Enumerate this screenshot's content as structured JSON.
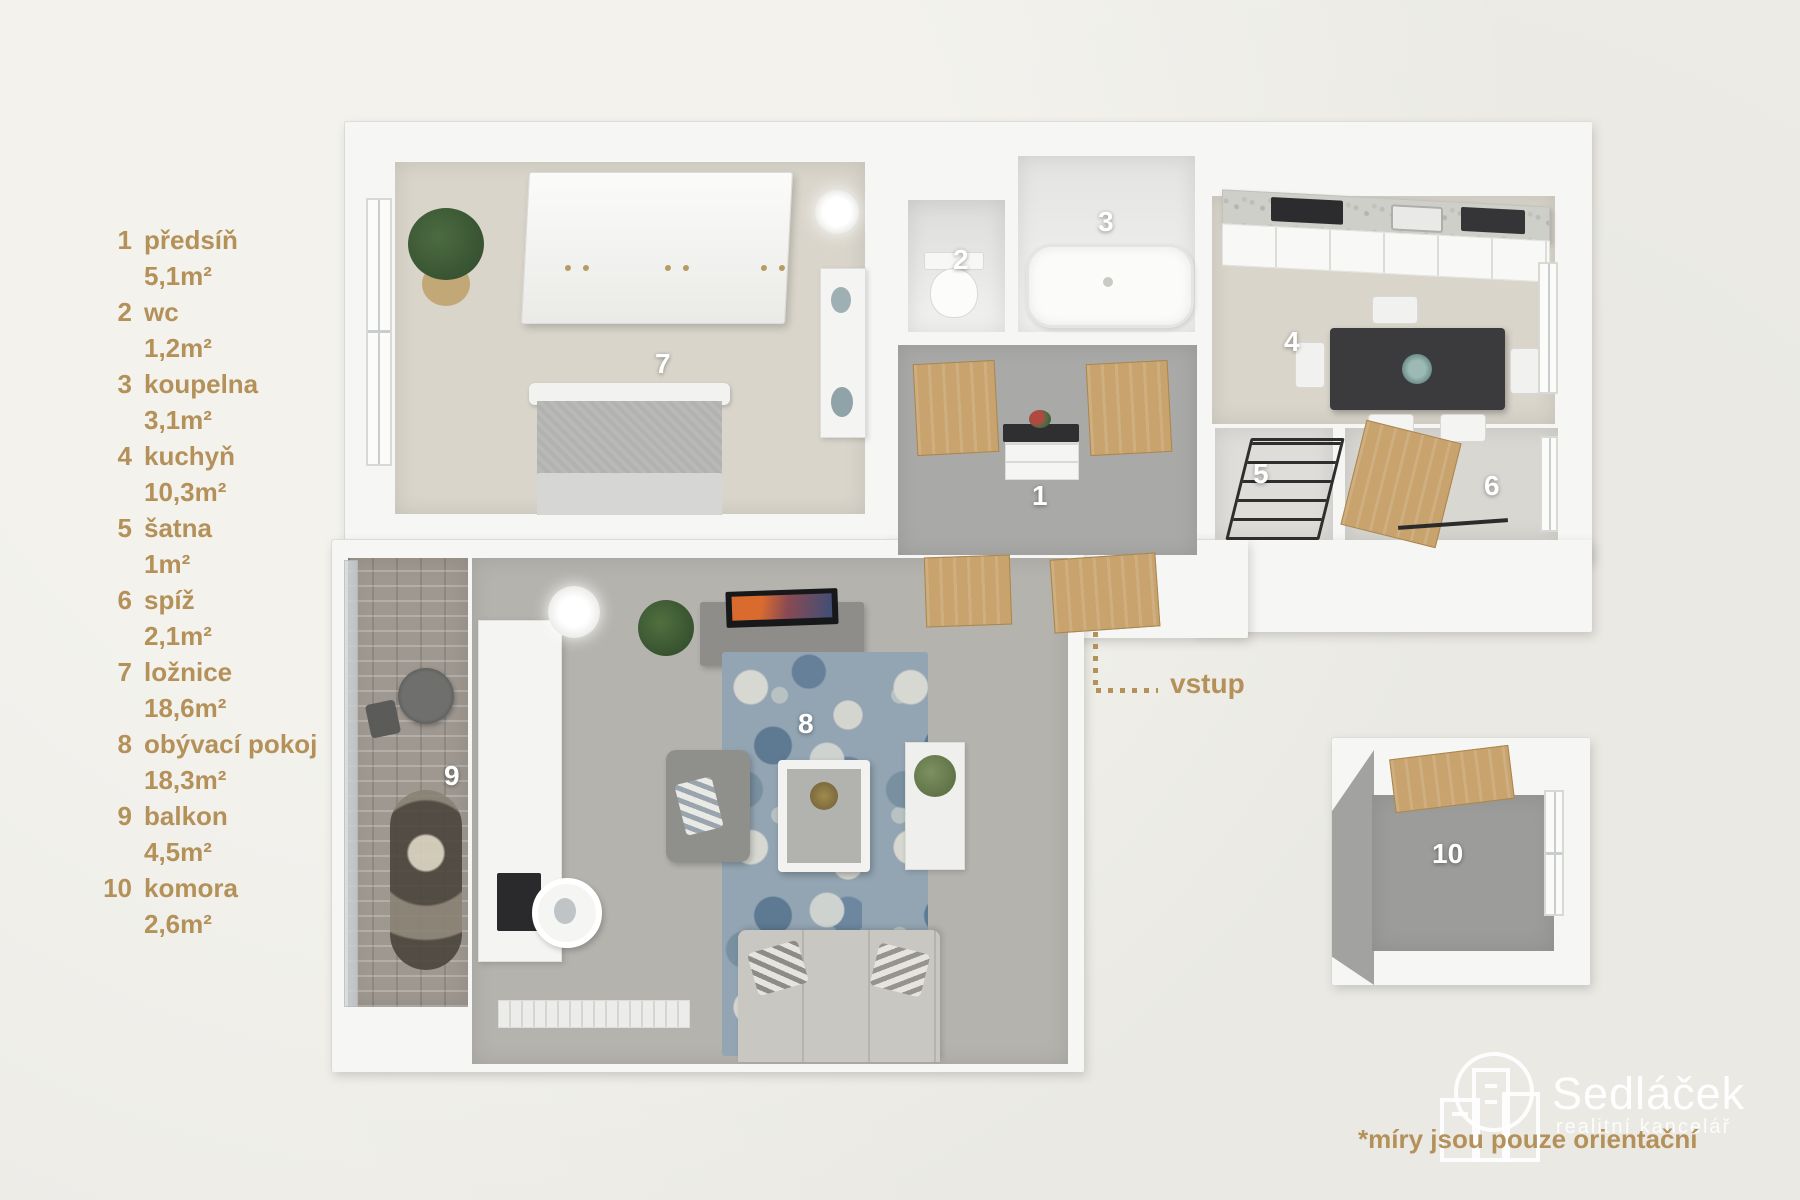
{
  "legend": {
    "items": [
      {
        "num": "1",
        "name": "předsíň",
        "area": "5,1m²"
      },
      {
        "num": "2",
        "name": "wc",
        "area": "1,2m²"
      },
      {
        "num": "3",
        "name": "koupelna",
        "area": "3,1m²"
      },
      {
        "num": "4",
        "name": "kuchyň",
        "area": "10,3m²"
      },
      {
        "num": "5",
        "name": "šatna",
        "area": "1m²"
      },
      {
        "num": "6",
        "name": "spíž",
        "area": "2,1m²"
      },
      {
        "num": "7",
        "name": "ložnice",
        "area": "18,6m²"
      },
      {
        "num": "8",
        "name": "obývací pokoj",
        "area": "18,3m²"
      },
      {
        "num": "9",
        "name": "balkon",
        "area": "4,5m²"
      },
      {
        "num": "10",
        "name": "komora",
        "area": "2,6m²"
      }
    ]
  },
  "plan": {
    "room_labels": [
      "1",
      "2",
      "3",
      "4",
      "5",
      "6",
      "7",
      "8",
      "9",
      "10"
    ],
    "entrance_label": "vstup"
  },
  "footer": {
    "brand_name": "Sedláček",
    "brand_subtitle": "realitní kancelář",
    "disclaimer": "*míry jsou pouze orientační"
  },
  "icons": {
    "entrance_marker": "dotted-l-line",
    "brand_logo": "buildings-outline"
  },
  "colors": {
    "background": "#EDECE7",
    "accent_gold": "#B5915A",
    "wall_white": "#F6F6F4",
    "floor_beige": "#D9D5CB",
    "floor_gray": "#A9A9A7",
    "door_wood": "#C8A36E",
    "room_label": "#FFFFFF"
  }
}
